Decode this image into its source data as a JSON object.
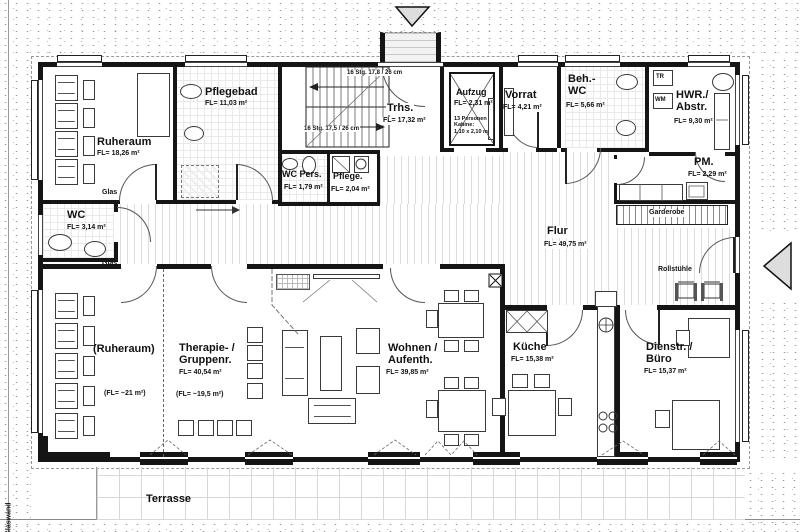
{
  "rooms": {
    "ruheraum_og": {
      "label": "Ruheraum",
      "area": "FL= 18,26 m²"
    },
    "pflegebad": {
      "label": "Pflegebad",
      "area": "FL= 11,03 m²"
    },
    "wc": {
      "label": "WC",
      "area": "FL= 3,14 m²"
    },
    "trhs": {
      "label": "Trhs.",
      "area": "FL= 17,32 m²"
    },
    "wc_pers": {
      "label": "WC Pers.",
      "area": "FL= 1,79 m²"
    },
    "pflege": {
      "label": "Pflege.",
      "area": "FL= 2,04 m²"
    },
    "aufzug": {
      "label": "Aufzug",
      "area": "FL= 2,31 m²",
      "notes": "13 Personen\nKabine:\n1,10 x 2,10 m"
    },
    "vorrat": {
      "label": "Vorrat",
      "area": "FL= 4,21 m²"
    },
    "beh_wc": {
      "label": "Beh.-\nWC",
      "area": "FL= 5,66 m²"
    },
    "hwr": {
      "label": "HWR./\nAbstr.",
      "area": "FL= 9,30 m²"
    },
    "pm": {
      "label": "PM.",
      "area": "FL= 2,29 m²"
    },
    "flur": {
      "label": "Flur",
      "area": "FL= 49,75 m²"
    },
    "ruheraum_eg": {
      "label": "(Ruheraum)",
      "area": "(FL= ~21 m²)"
    },
    "therapie": {
      "label": "Therapie- /\nGruppenr.",
      "area": "FL= 40,54 m²",
      "note": "(FL= ~19,5 m²)"
    },
    "wohnen": {
      "label": "Wohnen /\nAufenth.",
      "area": "FL= 39,85 m²"
    },
    "kueche": {
      "label": "Küche",
      "area": "FL= 15,38 m²"
    },
    "dienstr": {
      "label": "Dienstr. /\nBüro",
      "area": "FL= 15,37 m²"
    },
    "terrasse": {
      "label": "Terrasse"
    }
  },
  "annotations": {
    "stair_upper": "16 Stg. 17,8 / 26 cm",
    "stair_lower": "16 Stg. 17,5 / 26 cm",
    "garderobe": "Garderobe",
    "rollstuehle": "Rollstühle",
    "glas_upper": "Glas",
    "glas_lower": "Glas",
    "glaswand": "Glaswand",
    "tr": "TR",
    "wm": "WM"
  },
  "colors": {
    "wall": "#151515",
    "hatch": "#dcdcdc",
    "tile": "#e9e9e9",
    "arrow_fill": "#dddddd"
  }
}
